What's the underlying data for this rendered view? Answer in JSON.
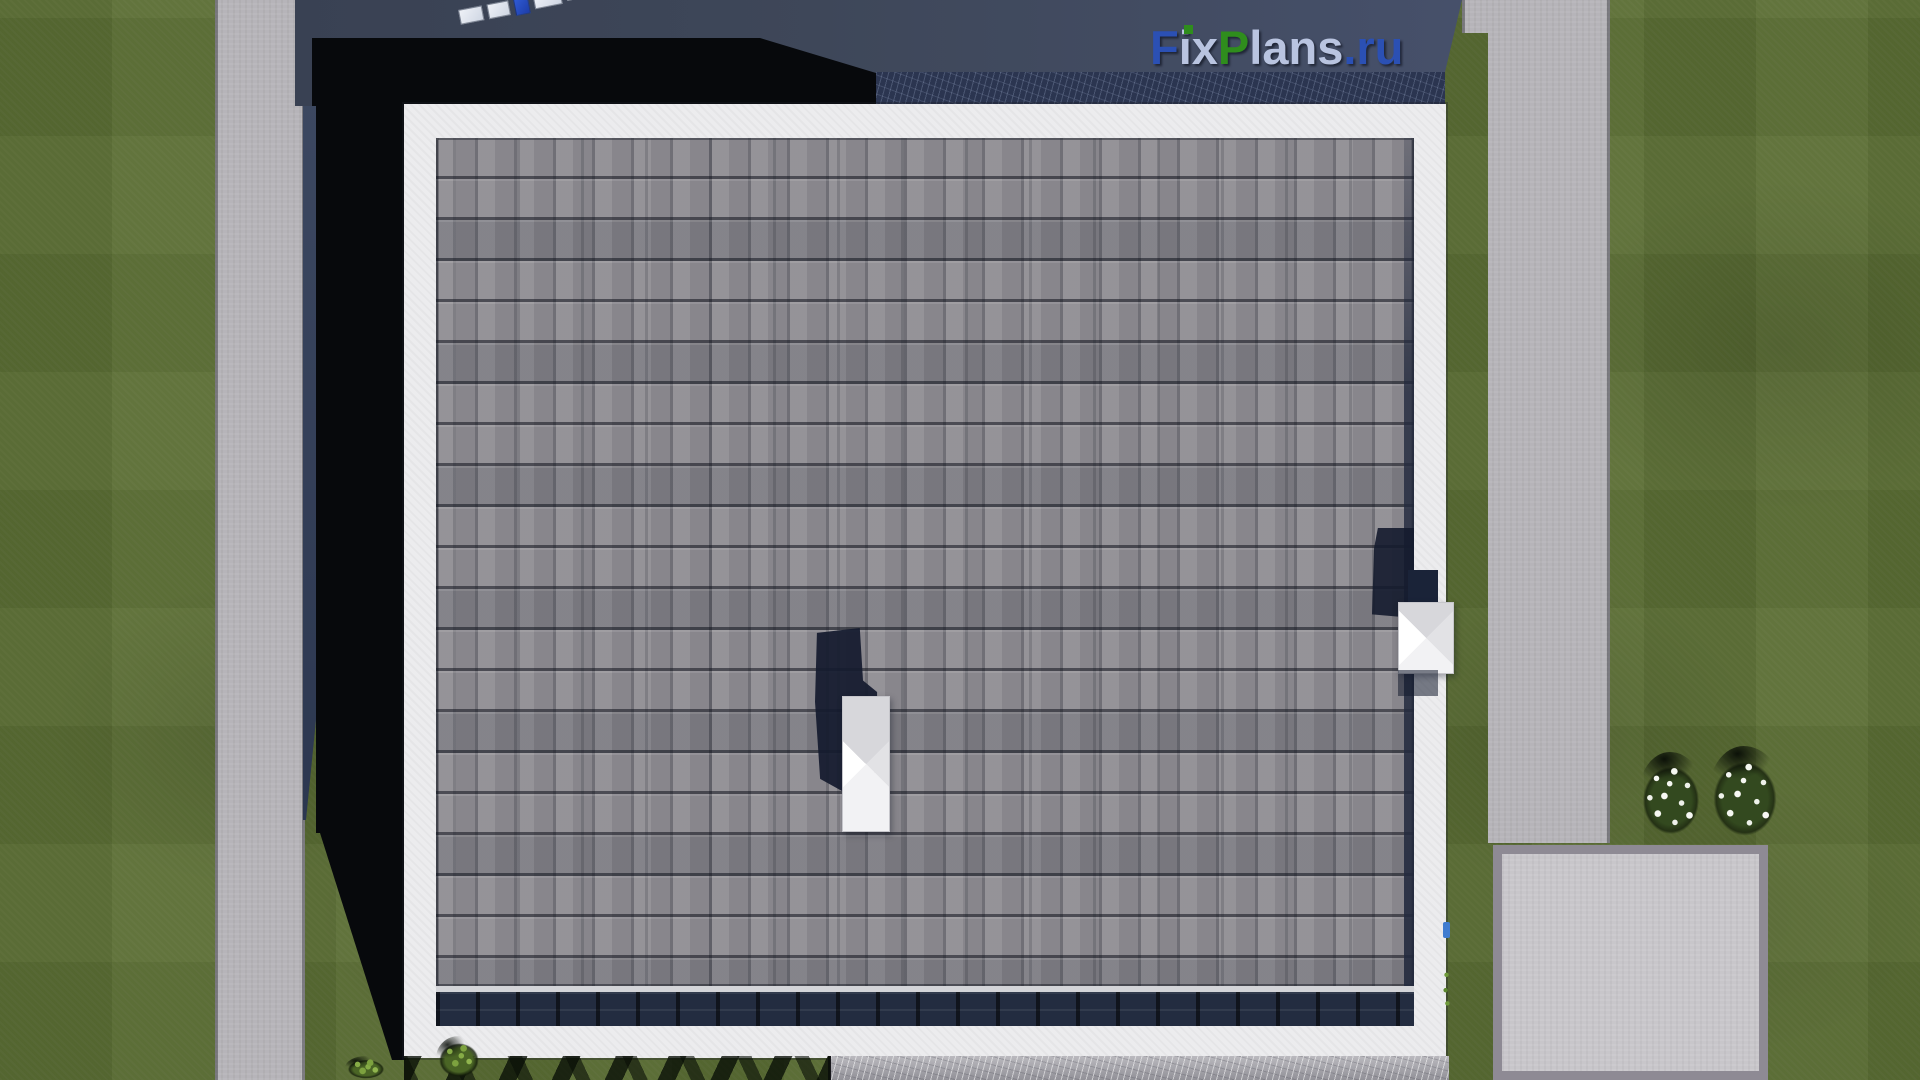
{
  "watermark": {
    "text": "FixPlans.ru",
    "segments": [
      {
        "part": "F",
        "color": "#2b50b4"
      },
      {
        "part": "ix",
        "color": "#b9c4e0"
      },
      {
        "part": "P",
        "color": "#2f8d1d"
      },
      {
        "part": "lans",
        "color": "#b9c4e0"
      },
      {
        "part": ".ru",
        "color": "#2b50b4"
      }
    ],
    "i_dot_color": "#2f8d1d"
  },
  "scene": {
    "type": "aerial-3d-architectural-render",
    "description": "Top-down bird's-eye render of a house with a gray asphalt-shingle hip roof and white eaves, surrounded by lawn, concrete walkways, a patio slab, flower bushes, and a neighboring dark roof casting a deep shadow.",
    "elements": [
      {
        "name": "house-roof",
        "description": "Large square gray shingle roof with white eave border"
      },
      {
        "name": "ridge-course",
        "description": "Dark navy shingle course above the bottom eave"
      },
      {
        "name": "chimney-cap",
        "description": "White beveled chimney/vent cap near roof center with cast shadow"
      },
      {
        "name": "roof-vent",
        "description": "White beveled vent cap on the right eave with dark inset and shadow"
      },
      {
        "name": "neighbor-roof",
        "description": "Dark slate-blue neighboring roof along the top edge"
      },
      {
        "name": "roof-panels",
        "description": "Row of small light rectangles and one blue panel on the neighbor roof"
      },
      {
        "name": "deep-shadow",
        "description": "Black cast shadow between left walkway and house"
      },
      {
        "name": "lawn-left",
        "description": "Green lawn, left side"
      },
      {
        "name": "lawn-right",
        "description": "Green lawn, right side"
      },
      {
        "name": "walkway-left",
        "description": "Vertical concrete walkway on the left"
      },
      {
        "name": "walkway-right",
        "description": "Vertical concrete walkway on the right"
      },
      {
        "name": "patio",
        "description": "Light concrete patio slab with darker border, bottom right"
      },
      {
        "name": "flower-bushes",
        "description": "Two bushes with white flowers right of the house"
      },
      {
        "name": "terrace-strip",
        "description": "Light scratched stone strip below the bottom eave"
      },
      {
        "name": "tree-shadows",
        "description": "Scalloped tree shadows on grass below the house"
      }
    ]
  },
  "palette": {
    "lawn": "#5b6e34",
    "concrete": "#b6b4b9",
    "patio_fill": "#c8c6ca",
    "patio_border": "#8e8a94",
    "eave_white": "#ececee",
    "shingle_gray": "#8f8d93",
    "ridge_navy": "#232c40",
    "neighbor_roof_navy": "#3e4759",
    "shadow_black": "#07090c",
    "logo_blue": "#2b50b4",
    "logo_silver": "#b9c4e0",
    "logo_green": "#2f8d1d"
  }
}
